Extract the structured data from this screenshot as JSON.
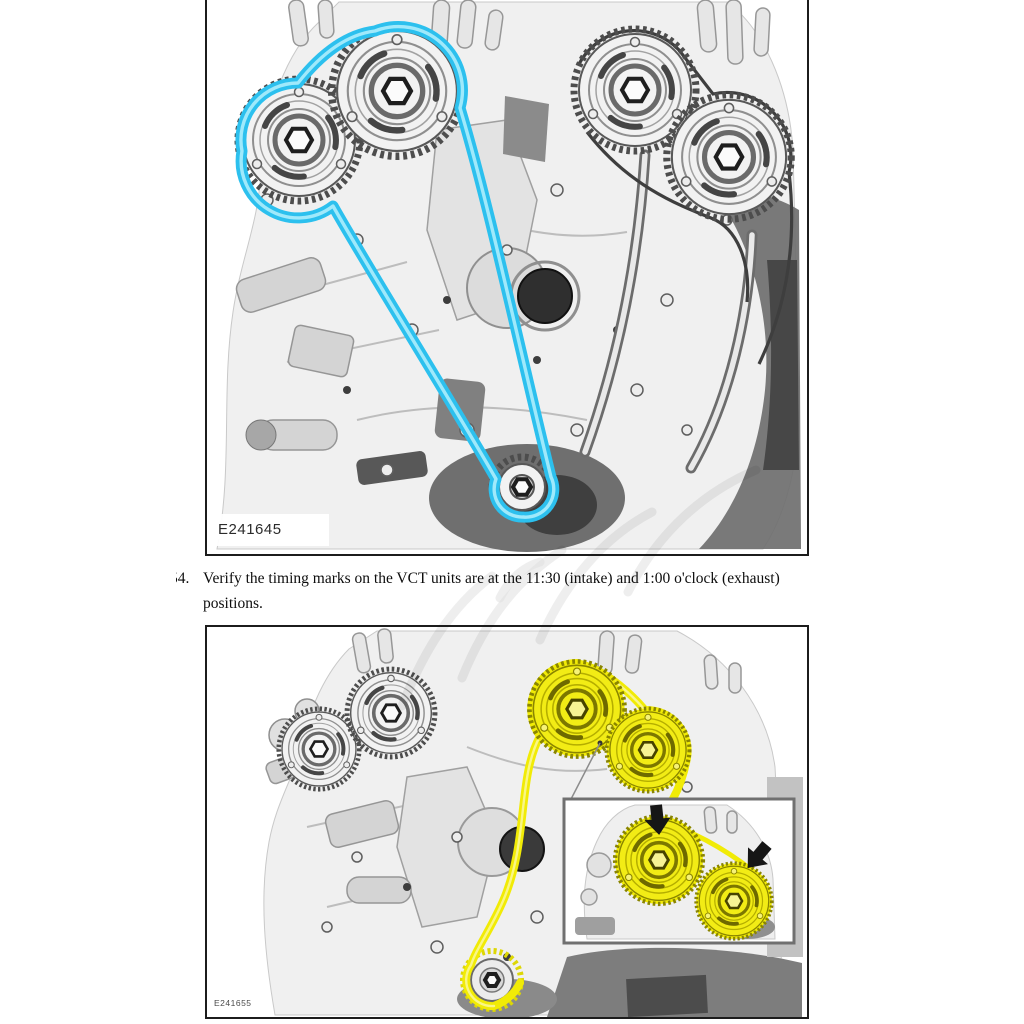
{
  "step": {
    "number": "54.",
    "text": "Verify the timing marks on the VCT units are at the 11:30 (intake) and 1:00 o'clock (exhaust) positions."
  },
  "figures": {
    "top": {
      "label": "E241645"
    },
    "bottom": {
      "label": "E241655"
    }
  },
  "colors": {
    "chain_blue": "#2cc0ee",
    "chain_yellow": "#f1eb06",
    "figure_border": "#1c1c1c"
  }
}
